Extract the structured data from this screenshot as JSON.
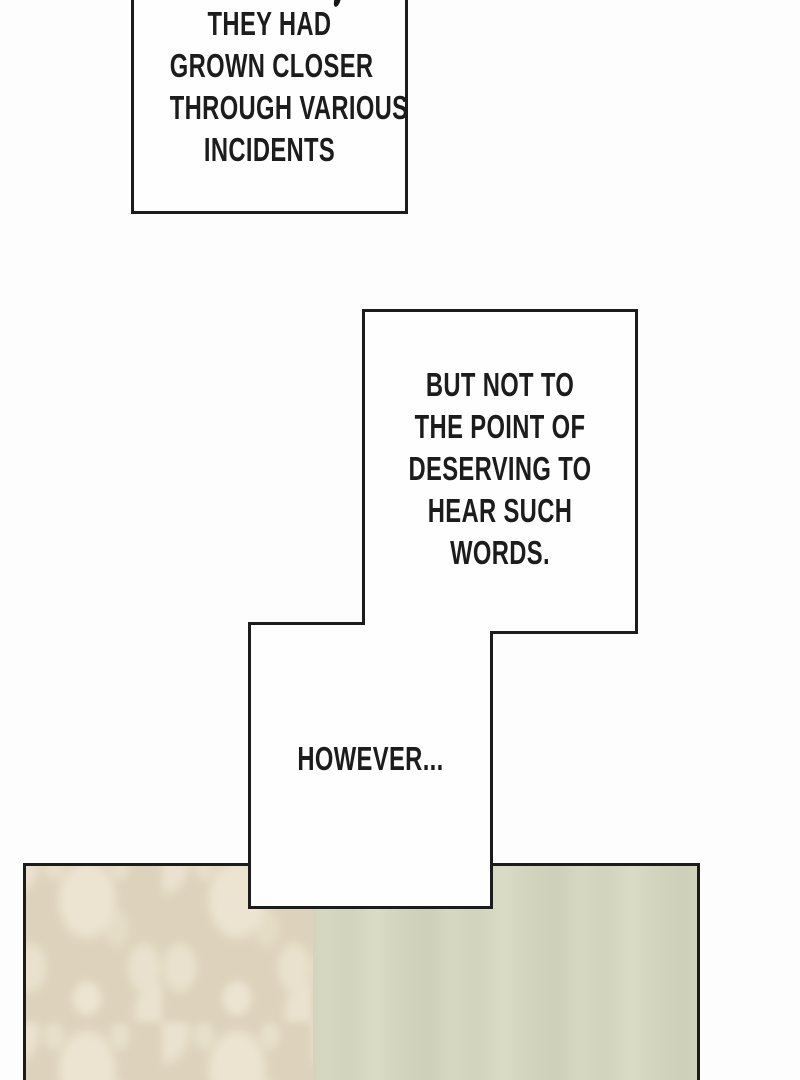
{
  "colors": {
    "ink": "#1c1c1c",
    "paper": "#fdfdfd",
    "bubble_fill": "#fefefe",
    "damask_base": "#ddd2bb",
    "damask_motif": "#ece4d1",
    "wall_base": "#d4d6c1",
    "wall_streak_dark": "#cdcfb8",
    "wall_streak_light": "#dadcc7"
  },
  "bubbles": {
    "top": {
      "clipped_line_fragment": ",",
      "lines": [
        "THEY HAD",
        "GROWN CLOSER",
        "THROUGH VARIOUS",
        "INCIDENTS"
      ]
    },
    "middle": {
      "lines": [
        "BUT NOT TO",
        "THE POINT OF",
        "DESERVING TO",
        "HEAR SUCH",
        "WORDS."
      ]
    },
    "lower": {
      "lines": [
        "HOWEVER..."
      ]
    }
  },
  "panel": {
    "sections": [
      "damask-wallpaper",
      "plain-wall"
    ]
  }
}
